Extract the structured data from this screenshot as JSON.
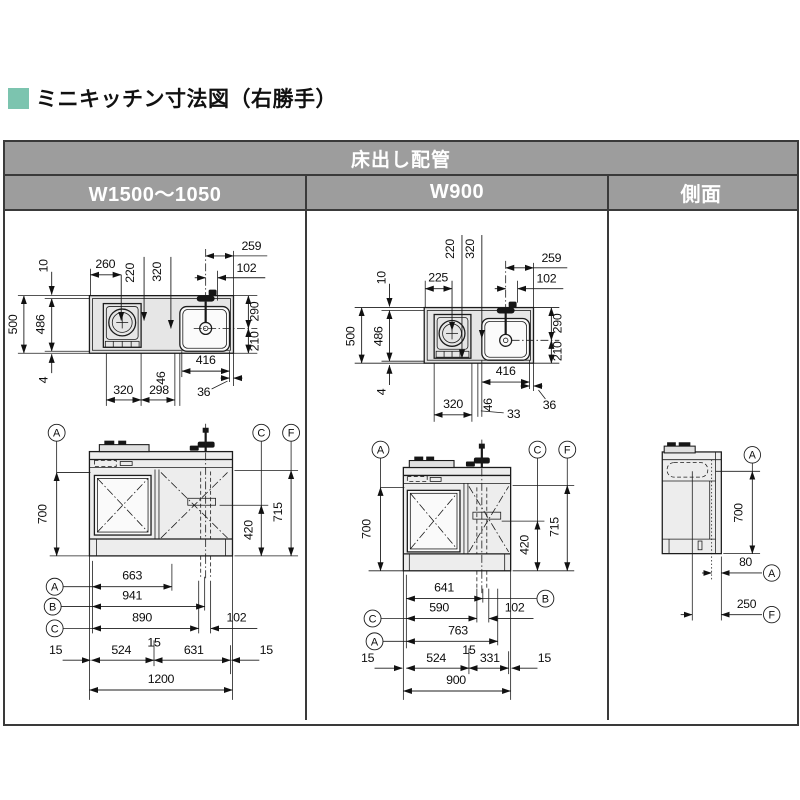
{
  "title": {
    "text": "ミニキッチン寸法図（右勝手）",
    "bullet_color": "#7cc4af"
  },
  "table": {
    "header": "床出し配管",
    "columns": [
      "W1500～1050",
      "W900",
      "側面"
    ],
    "header_bg": "#9d9d9d",
    "header_text_color": "#ffffff"
  },
  "w1500": {
    "plan": {
      "d260": "260",
      "d220": "220",
      "d320t": "320",
      "d259": "259",
      "d102": "102",
      "d10": "10",
      "d500": "500",
      "d486": "486",
      "d4": "4",
      "d320b": "320",
      "d298": "298",
      "d46": "46",
      "d416": "416",
      "d36": "36",
      "d290": "290",
      "d210": "210"
    },
    "elev": {
      "la": "A",
      "lc": "C",
      "lf": "F",
      "d700": "700",
      "d715": "715",
      "d420": "420",
      "la2": "A",
      "d663": "663",
      "lb2": "B",
      "d941": "941",
      "lc2": "C",
      "d890": "890",
      "d102": "102",
      "d15l": "15",
      "d524": "524",
      "d15m": "15",
      "d631": "631",
      "d15r": "15",
      "d1200": "1200"
    }
  },
  "w900": {
    "plan": {
      "d225": "225",
      "d220": "220",
      "d320t": "320",
      "d259": "259",
      "d102": "102",
      "d10": "10",
      "d500": "500",
      "d486": "486",
      "d4": "4",
      "d320b": "320",
      "d46": "46",
      "d33": "33",
      "d416": "416",
      "d36": "36",
      "d290": "290",
      "d210": "210"
    },
    "elev": {
      "la": "A",
      "lc": "C",
      "lf": "F",
      "d700": "700",
      "d715": "715",
      "d420": "420",
      "d641": "641",
      "lb2": "B",
      "lc2": "C",
      "d590": "590",
      "d102": "102",
      "la2": "A",
      "d763": "763",
      "d15l": "15",
      "d524": "524",
      "d15m": "15",
      "d331": "331",
      "d15r": "15",
      "d900": "900"
    }
  },
  "side": {
    "la_top": "A",
    "d700": "700",
    "d80": "80",
    "la": "A",
    "d250": "250",
    "lf": "F"
  }
}
